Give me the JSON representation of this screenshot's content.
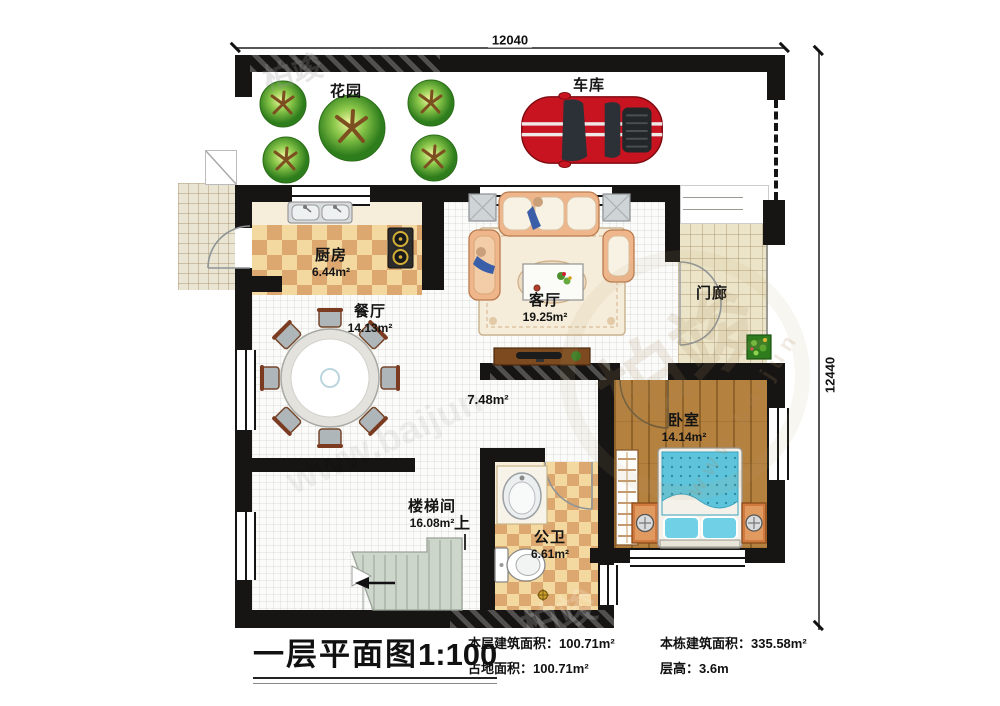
{
  "sheet": {
    "title_main": "一层平面图",
    "title_scale": "1:100"
  },
  "dimensions": {
    "top": "12040",
    "right": "12440"
  },
  "outdoor": {
    "garden": "花园",
    "garage": "车库"
  },
  "rooms": {
    "kitchen": {
      "name": "厨房",
      "area": "6.44m²"
    },
    "dining": {
      "name": "餐厅",
      "area": "14.13m²"
    },
    "living": {
      "name": "客厅",
      "area": "19.25m²"
    },
    "porch": {
      "name": "门廊"
    },
    "hall": {
      "area": "7.48m²"
    },
    "bedroom": {
      "name": "卧室",
      "area": "14.14m²"
    },
    "stair": {
      "name": "楼梯间",
      "area": "16.08m²",
      "up": "上"
    },
    "bath": {
      "name": "公卫",
      "area": "6.61m²"
    }
  },
  "stats": {
    "floor_area_label": "本层建筑面积：",
    "floor_area_value": "100.71m²",
    "site_area_label": "占地面积：",
    "site_area_value": "100.71m²",
    "total_area_label": "本栋建筑面积：",
    "total_area_value": "335.58m²",
    "height_label": "层高：",
    "height_value": "3.6m"
  },
  "watermark": {
    "brand": "柏竣",
    "url": "www.baijun"
  },
  "colors": {
    "wall": "#171513",
    "car_red": "#c81420",
    "wood_floor": "#b5813f",
    "checker_light": "#f3d8a0",
    "checker_dark": "#dca86f",
    "bed_blue": "#5ec4dc",
    "tree_green": "#52a32c"
  }
}
